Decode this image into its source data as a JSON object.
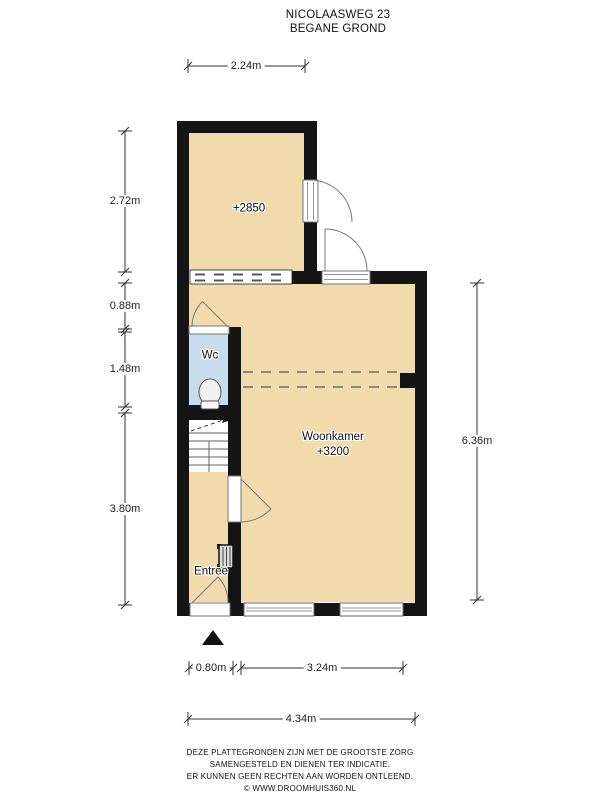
{
  "title": {
    "address": "NICOLAASWEG 23",
    "floor": "BEGANE GROND"
  },
  "rooms": {
    "extension_label": "+2850",
    "wc_label": "Wc",
    "living_label": "Woonkamer",
    "living_height_label": "+3200",
    "entry_label": "Entree"
  },
  "dimensions": {
    "top_width": "2.24m",
    "left_extension": "2.72m",
    "left_upper": "0.88m",
    "left_wc": "1.48m",
    "left_lower": "3.80m",
    "right_living": "6.36m",
    "bottom_door": "0.80m",
    "bottom_window": "3.24m",
    "bottom_total": "4.34m"
  },
  "footer": {
    "line1": "DEZE PLATTEGRONDEN ZIJN MET DE GROOTSTE ZORG",
    "line2": "SAMENGESTELD EN DIENEN TER INDICATIE.",
    "line3": "ER KUNNEN GEEN RECHTEN AAN WORDEN ONTLEEND.",
    "line4": "© WWW.DROOMHUIS360.NL"
  },
  "colors": {
    "floor": "#f1dbac",
    "wc_floor": "#c8dcee",
    "wall": "#141414",
    "dimension": "#333333"
  }
}
